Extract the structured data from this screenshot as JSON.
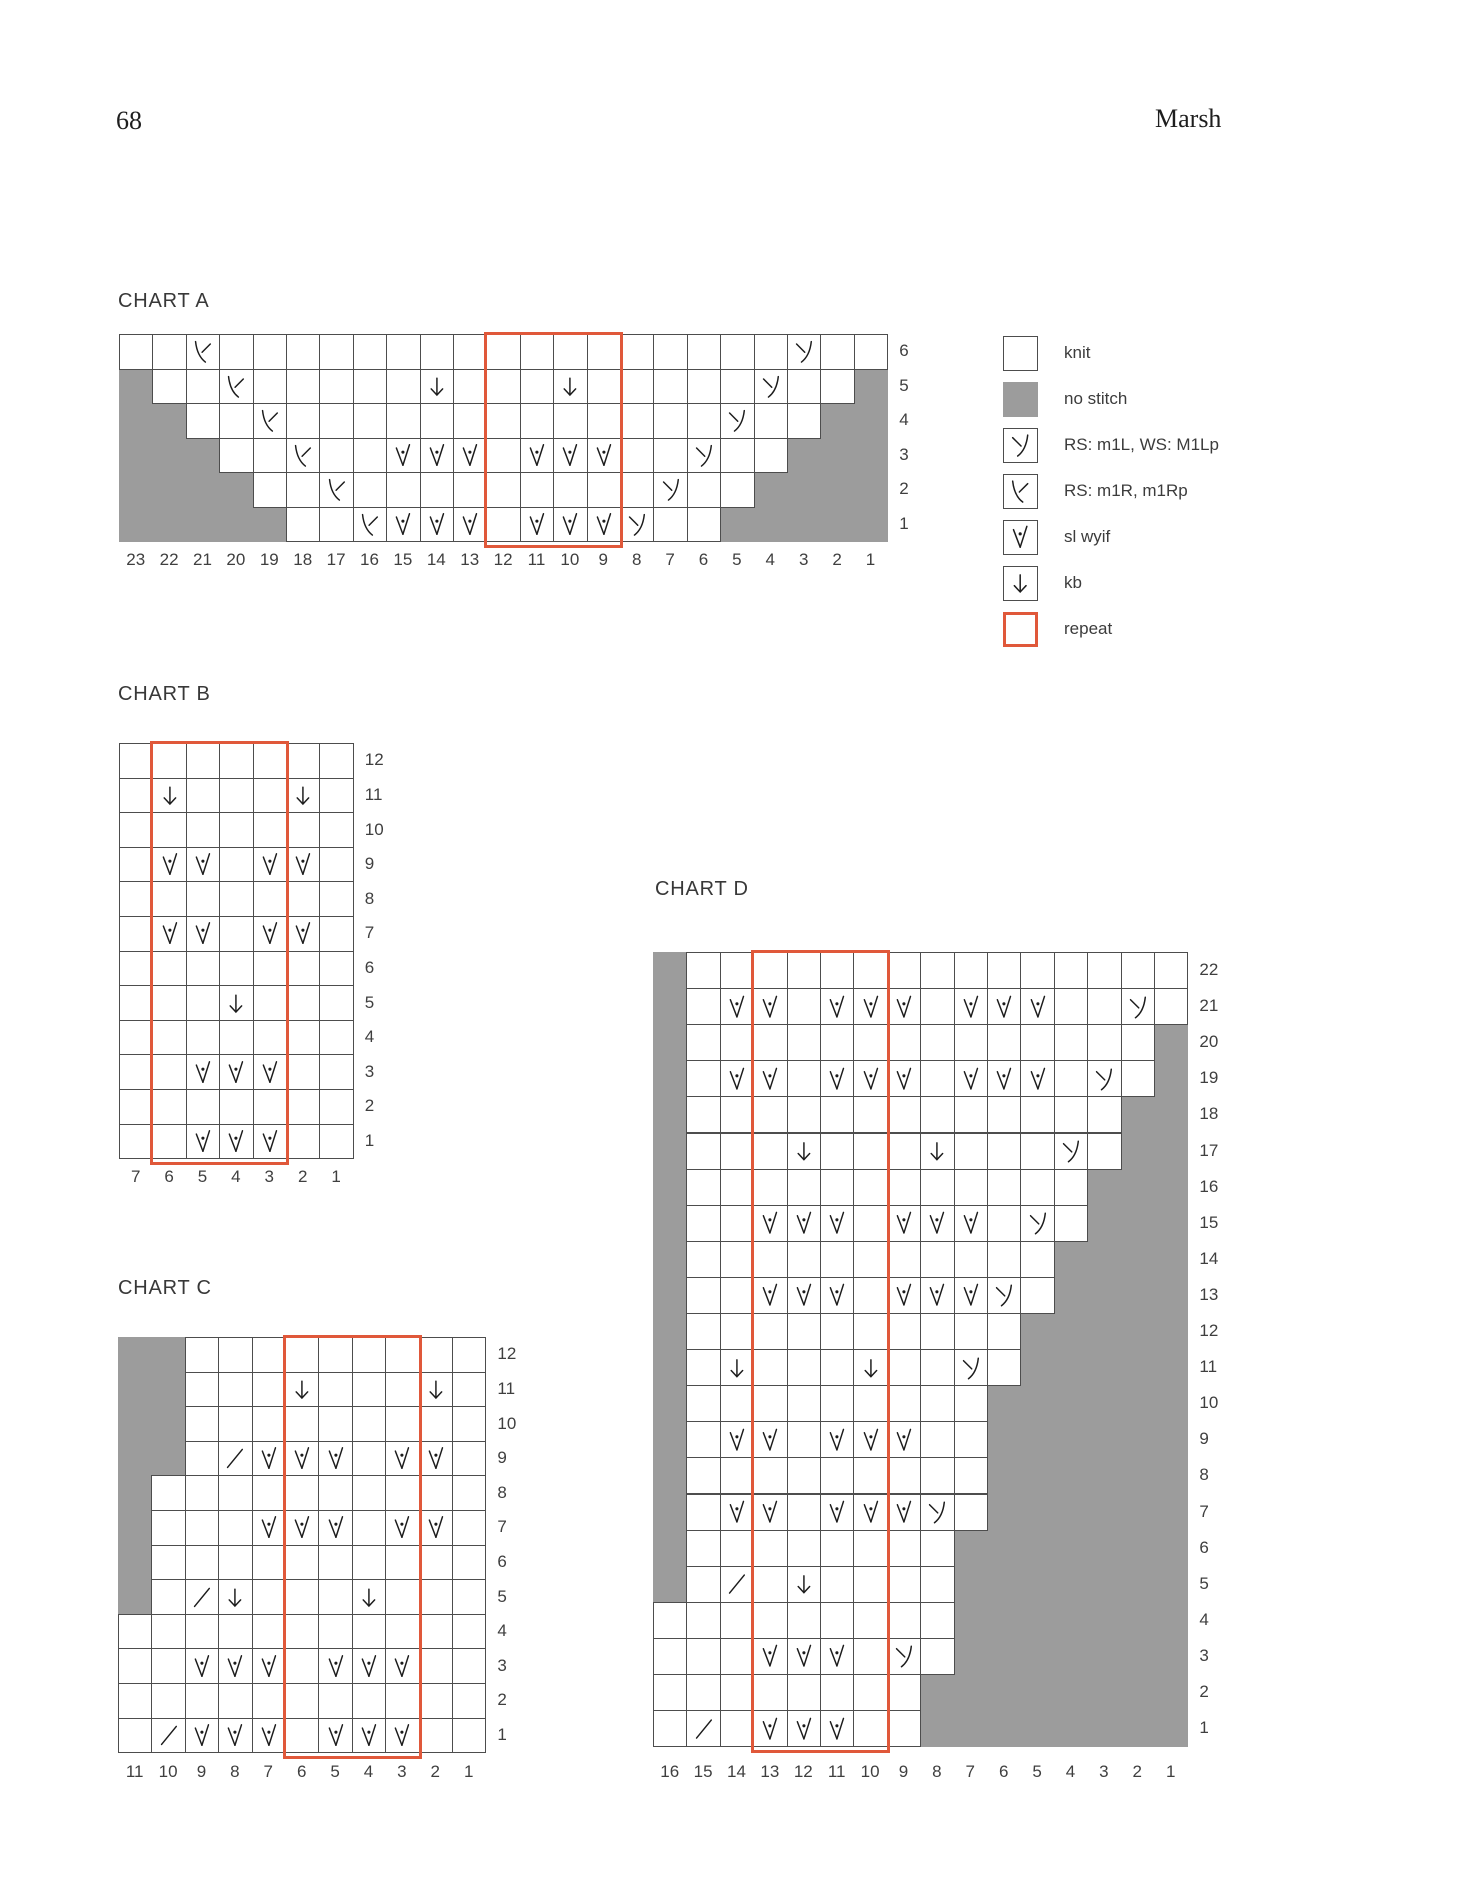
{
  "page": {
    "number": "68",
    "running_head": "Marsh"
  },
  "colors": {
    "no_stitch": "#9c9c9c",
    "grid_line": "#4d4d4d",
    "repeat_outline": "#e0583a",
    "symbol": "#1c1c1c"
  },
  "legend": {
    "items": [
      {
        "symbol": "knit",
        "label": "knit"
      },
      {
        "symbol": "no-stitch",
        "label": "no stitch"
      },
      {
        "symbol": "m1l",
        "label": "RS: m1L, WS: M1Lp"
      },
      {
        "symbol": "m1r",
        "label": "RS: m1R, m1Rp"
      },
      {
        "symbol": "sl-wyif",
        "label": "sl wyif"
      },
      {
        "symbol": "kb",
        "label": "kb"
      },
      {
        "symbol": "repeat",
        "label": "repeat"
      }
    ]
  },
  "charts": {
    "a": {
      "title": "CHART A",
      "cols": 23,
      "repeat_from": 12,
      "repeat_to": 9,
      "col_labels": [
        "23",
        "22",
        "21",
        "20",
        "19",
        "18",
        "17",
        "16",
        "15",
        "14",
        "13",
        "12",
        "11",
        "10",
        "9",
        "8",
        "7",
        "6",
        "5",
        "4",
        "3",
        "2",
        "1"
      ],
      "rows": [
        {
          "label": "6",
          "grey": [],
          "symbols": {
            "21": "m1r",
            "3": "m1l"
          }
        },
        {
          "label": "5",
          "grey": [
            23,
            1
          ],
          "symbols": {
            "20": "m1r",
            "14": "kb",
            "10": "kb",
            "4": "m1l"
          }
        },
        {
          "label": "4",
          "grey": [
            23,
            22,
            2,
            1
          ],
          "symbols": {
            "19": "m1r",
            "5": "m1l"
          }
        },
        {
          "label": "3",
          "grey": [
            23,
            22,
            21,
            3,
            2,
            1
          ],
          "symbols": {
            "18": "m1r",
            "15": "sl",
            "14": "sl",
            "13": "sl",
            "11": "sl",
            "10": "sl",
            "9": "sl",
            "6": "m1l"
          }
        },
        {
          "label": "2",
          "grey": [
            23,
            22,
            21,
            20,
            4,
            3,
            2,
            1
          ],
          "symbols": {
            "17": "m1r",
            "7": "m1l"
          }
        },
        {
          "label": "1",
          "grey": [
            23,
            22,
            21,
            20,
            19,
            5,
            4,
            3,
            2,
            1
          ],
          "symbols": {
            "16": "m1r",
            "15": "sl",
            "14": "sl",
            "13": "sl",
            "11": "sl",
            "10": "sl",
            "9": "sl",
            "8": "m1l"
          }
        }
      ]
    },
    "b": {
      "title": "CHART B",
      "cols": 7,
      "repeat_from": 6,
      "repeat_to": 3,
      "col_labels": [
        "7",
        "6",
        "5",
        "4",
        "3",
        "2",
        "1"
      ],
      "rows": [
        {
          "label": "12",
          "grey": [],
          "symbols": {}
        },
        {
          "label": "11",
          "grey": [],
          "symbols": {
            "6": "kb",
            "2": "kb"
          }
        },
        {
          "label": "10",
          "grey": [],
          "symbols": {}
        },
        {
          "label": "9",
          "grey": [],
          "symbols": {
            "6": "sl",
            "5": "sl",
            "3": "sl",
            "2": "sl"
          }
        },
        {
          "label": "8",
          "grey": [],
          "symbols": {}
        },
        {
          "label": "7",
          "grey": [],
          "symbols": {
            "6": "sl",
            "5": "sl",
            "3": "sl",
            "2": "sl"
          }
        },
        {
          "label": "6",
          "grey": [],
          "symbols": {}
        },
        {
          "label": "5",
          "grey": [],
          "symbols": {
            "4": "kb"
          }
        },
        {
          "label": "4",
          "grey": [],
          "symbols": {}
        },
        {
          "label": "3",
          "grey": [],
          "symbols": {
            "5": "sl",
            "4": "sl",
            "3": "sl"
          }
        },
        {
          "label": "2",
          "grey": [],
          "symbols": {}
        },
        {
          "label": "1",
          "grey": [],
          "symbols": {
            "5": "sl",
            "4": "sl",
            "3": "sl"
          }
        }
      ]
    },
    "c": {
      "title": "CHART C",
      "cols": 11,
      "repeat_from": 6,
      "repeat_to": 3,
      "col_labels": [
        "11",
        "10",
        "9",
        "8",
        "7",
        "6",
        "5",
        "4",
        "3",
        "2",
        "1"
      ],
      "rows": [
        {
          "label": "12",
          "grey": [
            11,
            10
          ],
          "symbols": {}
        },
        {
          "label": "11",
          "grey": [
            11,
            10
          ],
          "symbols": {
            "6": "kb",
            "2": "kb"
          }
        },
        {
          "label": "10",
          "grey": [
            11,
            10
          ],
          "symbols": {}
        },
        {
          "label": "9",
          "grey": [
            11,
            10
          ],
          "symbols": {
            "8": "k2tog",
            "7": "sl",
            "6": "sl",
            "5": "sl",
            "3": "sl",
            "2": "sl"
          }
        },
        {
          "label": "8",
          "grey": [
            11
          ],
          "symbols": {}
        },
        {
          "label": "7",
          "grey": [
            11
          ],
          "symbols": {
            "7": "sl",
            "6": "sl",
            "5": "sl",
            "3": "sl",
            "2": "sl"
          }
        },
        {
          "label": "6",
          "grey": [
            11
          ],
          "symbols": {}
        },
        {
          "label": "5",
          "grey": [
            11
          ],
          "symbols": {
            "9": "k2tog",
            "8": "kb",
            "4": "kb"
          }
        },
        {
          "label": "4",
          "grey": [],
          "symbols": {}
        },
        {
          "label": "3",
          "grey": [],
          "symbols": {
            "9": "sl",
            "8": "sl",
            "7": "sl",
            "5": "sl",
            "4": "sl",
            "3": "sl"
          }
        },
        {
          "label": "2",
          "grey": [],
          "symbols": {}
        },
        {
          "label": "1",
          "grey": [],
          "symbols": {
            "10": "k2tog",
            "9": "sl",
            "8": "sl",
            "7": "sl",
            "5": "sl",
            "4": "sl",
            "3": "sl"
          }
        }
      ]
    },
    "d": {
      "title": "CHART D",
      "cols": 16,
      "repeat_from": 13,
      "repeat_to": 10,
      "col_labels": [
        "16",
        "15",
        "14",
        "13",
        "12",
        "11",
        "10",
        "9",
        "8",
        "7",
        "6",
        "5",
        "4",
        "3",
        "2",
        "1"
      ],
      "rows": [
        {
          "label": "22",
          "grey": [
            16
          ],
          "symbols": {}
        },
        {
          "label": "21",
          "grey": [
            16
          ],
          "symbols": {
            "14": "sl",
            "13": "sl",
            "11": "sl",
            "10": "sl",
            "9": "sl",
            "7": "sl",
            "6": "sl",
            "5": "sl",
            "2": "m1l"
          }
        },
        {
          "label": "20",
          "grey": [
            16,
            1
          ],
          "symbols": {}
        },
        {
          "label": "19",
          "grey": [
            16,
            1
          ],
          "symbols": {
            "14": "sl",
            "13": "sl",
            "11": "sl",
            "10": "sl",
            "9": "sl",
            "7": "sl",
            "6": "sl",
            "5": "sl",
            "3": "m1l"
          }
        },
        {
          "label": "18",
          "grey": [
            16,
            2,
            1
          ],
          "symbols": {}
        },
        {
          "label": "17",
          "grey": [
            16,
            2,
            1
          ],
          "symbols": {
            "12": "kb",
            "8": "kb",
            "4": "m1l"
          }
        },
        {
          "label": "16",
          "grey": [
            16,
            3,
            2,
            1
          ],
          "symbols": {}
        },
        {
          "label": "15",
          "grey": [
            16,
            3,
            2,
            1
          ],
          "symbols": {
            "13": "sl",
            "12": "sl",
            "11": "sl",
            "9": "sl",
            "8": "sl",
            "7": "sl",
            "5": "m1l"
          }
        },
        {
          "label": "14",
          "grey": [
            16,
            4,
            3,
            2,
            1
          ],
          "symbols": {}
        },
        {
          "label": "13",
          "grey": [
            16,
            4,
            3,
            2,
            1
          ],
          "symbols": {
            "13": "sl",
            "12": "sl",
            "11": "sl",
            "9": "sl",
            "8": "sl",
            "7": "sl",
            "6": "m1l"
          }
        },
        {
          "label": "12",
          "grey": [
            16,
            5,
            4,
            3,
            2,
            1
          ],
          "symbols": {}
        },
        {
          "label": "11",
          "grey": [
            16,
            5,
            4,
            3,
            2,
            1
          ],
          "symbols": {
            "14": "kb",
            "10": "kb",
            "7": "m1l"
          }
        },
        {
          "label": "10",
          "grey": [
            16,
            6,
            5,
            4,
            3,
            2,
            1
          ],
          "symbols": {}
        },
        {
          "label": "9",
          "grey": [
            16,
            6,
            5,
            4,
            3,
            2,
            1
          ],
          "symbols": {
            "14": "sl",
            "13": "sl",
            "11": "sl",
            "10": "sl",
            "9": "sl"
          }
        },
        {
          "label": "8",
          "grey": [
            16,
            6,
            5,
            4,
            3,
            2,
            1
          ],
          "symbols": {}
        },
        {
          "label": "7",
          "grey": [
            16,
            6,
            5,
            4,
            3,
            2,
            1
          ],
          "symbols": {
            "14": "sl",
            "13": "sl",
            "11": "sl",
            "10": "sl",
            "9": "sl",
            "8": "m1l"
          }
        },
        {
          "label": "6",
          "grey": [
            16,
            7,
            6,
            5,
            4,
            3,
            2,
            1
          ],
          "symbols": {}
        },
        {
          "label": "5",
          "grey": [
            16,
            7,
            6,
            5,
            4,
            3,
            2,
            1
          ],
          "symbols": {
            "14": "k2tog",
            "12": "kb"
          }
        },
        {
          "label": "4",
          "grey": [
            7,
            6,
            5,
            4,
            3,
            2,
            1
          ],
          "symbols": {}
        },
        {
          "label": "3",
          "grey": [
            7,
            6,
            5,
            4,
            3,
            2,
            1
          ],
          "symbols": {
            "13": "sl",
            "12": "sl",
            "11": "sl",
            "9": "m1l"
          }
        },
        {
          "label": "2",
          "grey": [
            8,
            7,
            6,
            5,
            4,
            3,
            2,
            1
          ],
          "symbols": {}
        },
        {
          "label": "1",
          "grey": [
            8,
            7,
            6,
            5,
            4,
            3,
            2,
            1
          ],
          "symbols": {
            "15": "k2tog",
            "13": "sl",
            "12": "sl",
            "11": "sl"
          }
        }
      ]
    }
  }
}
